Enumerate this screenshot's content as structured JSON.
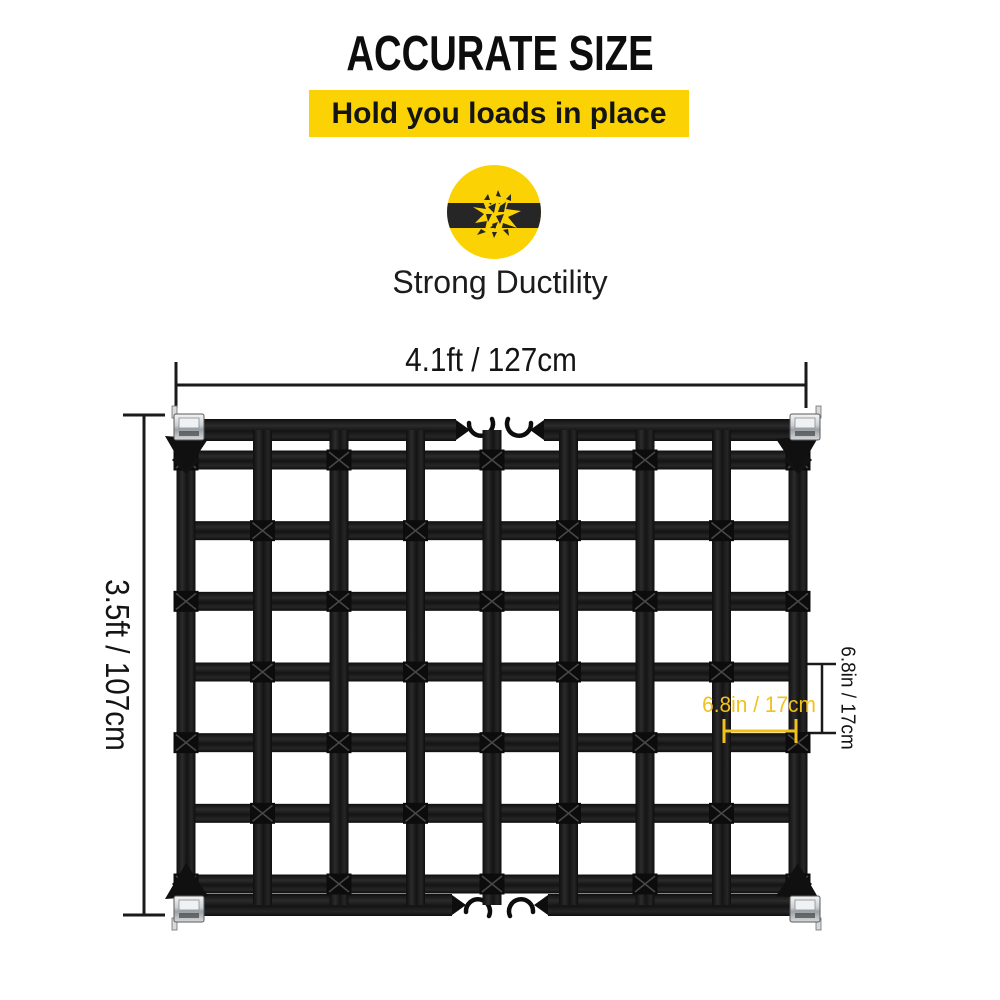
{
  "title": "ACCURATE SIZE",
  "banner": {
    "text": "Hold you loads in place"
  },
  "feature": {
    "label": "Strong Ductility",
    "icon": "broken-strap-burst-icon"
  },
  "dimensions": {
    "width_label": "4.1ft / 127cm",
    "height_label": "3.5ft / 107cm",
    "cell_height_label": "6.8in / 17cm",
    "cell_width_label": "6.8in / 17cm"
  },
  "net": {
    "columns": 8,
    "rows": 6,
    "corner_buckles": 4,
    "s_hooks": 4,
    "description": "black webbing cargo net with cam buckles at corners and paired S-hooks top and bottom"
  },
  "colors": {
    "brand_yellow": "#FBD304",
    "dim_yellow": "#F2C11B",
    "text_black": "#111111",
    "strap_black": "#151515",
    "buckle_silver": "#C9CDD1",
    "icon_bar": "#262626"
  }
}
